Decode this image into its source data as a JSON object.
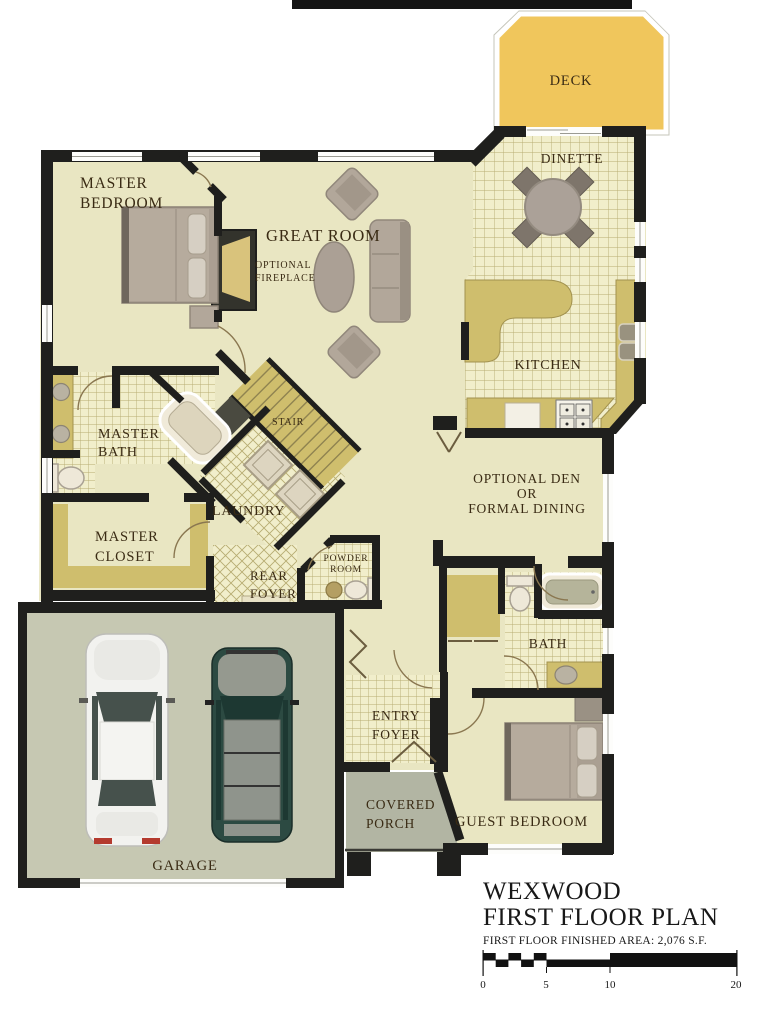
{
  "title_block": {
    "plan_name": "WEXWOOD",
    "sheet_title": "FIRST FLOOR PLAN",
    "area_note": "FIRST FLOOR FINISHED AREA:  2,076 S.F.",
    "scale_ticks": [
      "0",
      "5",
      "10",
      "20"
    ]
  },
  "rooms": {
    "deck": {
      "label": [
        "DECK"
      ]
    },
    "dinette": {
      "label": [
        "DINETTE"
      ]
    },
    "master_bedroom": {
      "label": [
        "MASTER",
        "BEDROOM"
      ]
    },
    "great_room": {
      "label": [
        "GREAT ROOM"
      ]
    },
    "optional_fireplace": {
      "label": [
        "OPTIONAL",
        "FIREPLACE"
      ]
    },
    "kitchen": {
      "label": [
        "KITCHEN"
      ]
    },
    "optional_den": {
      "label": [
        "OPTIONAL DEN",
        "OR",
        "FORMAL DINING"
      ]
    },
    "master_bath": {
      "label": [
        "MASTER",
        "BATH"
      ]
    },
    "stair": {
      "label": [
        "STAIR"
      ]
    },
    "laundry": {
      "label": [
        "LAUNDRY"
      ]
    },
    "master_closet": {
      "label": [
        "MASTER",
        "CLOSET"
      ]
    },
    "rear_foyer": {
      "label": [
        "REAR",
        "FOYER"
      ]
    },
    "powder_room": {
      "label": [
        "POWDER",
        "ROOM"
      ]
    },
    "bath": {
      "label": [
        "BATH"
      ]
    },
    "entry_foyer": {
      "label": [
        "ENTRY",
        "FOYER"
      ]
    },
    "covered_porch": {
      "label": [
        "COVERED",
        "PORCH"
      ]
    },
    "guest_bedroom": {
      "label": [
        "GUEST BEDROOM"
      ]
    },
    "garage": {
      "label": [
        "GARAGE"
      ]
    }
  },
  "colors": {
    "wall": "#1f1f1d",
    "floor": "#e9e6c2",
    "tile_floor": "#f1eecb",
    "tile_line": "#b7ac72",
    "deck": "#f0c65c",
    "counter_tan": "#cfbe6d",
    "garage_floor": "#c6c8b2",
    "porch_gray": "#b2b5a3",
    "furniture_taupe": "#b2a79a",
    "label_text": "#3a2b14"
  }
}
